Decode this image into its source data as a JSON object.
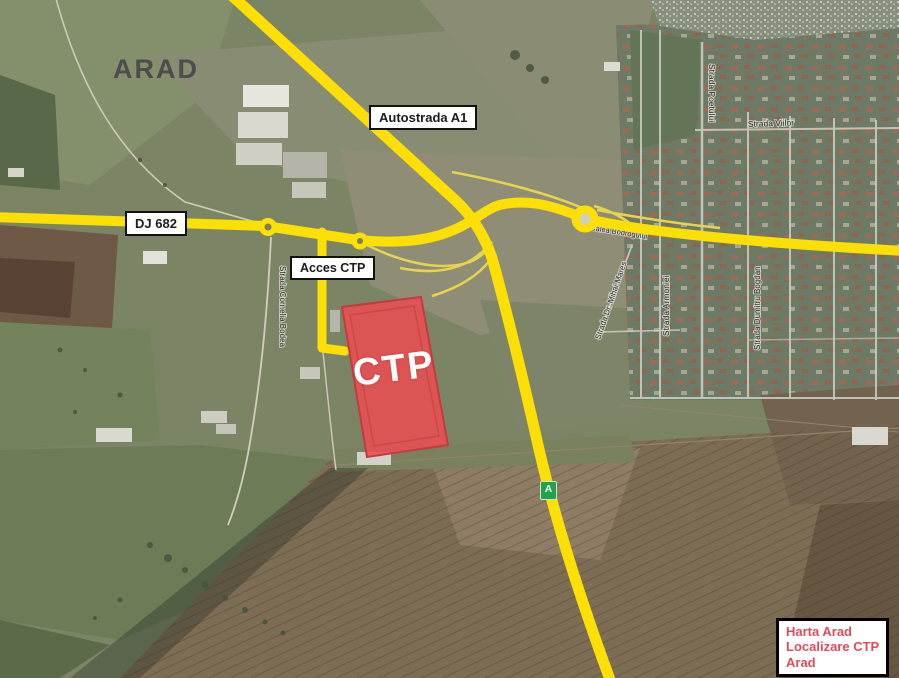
{
  "map": {
    "city": "ARAD",
    "site": "CTP",
    "badge": "A",
    "roads": {
      "autostrada": "Autostrada A1",
      "dj682": "DJ 682",
      "acces": "Acces CTP"
    },
    "streets": {
      "poetului": "Strada Poetului",
      "viilor": "Strada Viilor",
      "bodrogului": "Calea Bodrogului",
      "mares": "Strada Dr. Mihai Mares",
      "armoniei": "Strada Armoniei",
      "dumitru": "Strada Dumitru Bogdan",
      "bodea": "Strada Cornelia Bodea"
    },
    "legend": {
      "line1": "Harta Arad",
      "line2": "Localizare CTP",
      "line3": "Arad"
    },
    "colors": {
      "road_yellow": "#fcdf05",
      "ramp_yellow": "#e6d44e",
      "ctp_fill": "#e94d52",
      "legend_text": "#e04b5a",
      "badge_green": "#23a24d"
    }
  }
}
